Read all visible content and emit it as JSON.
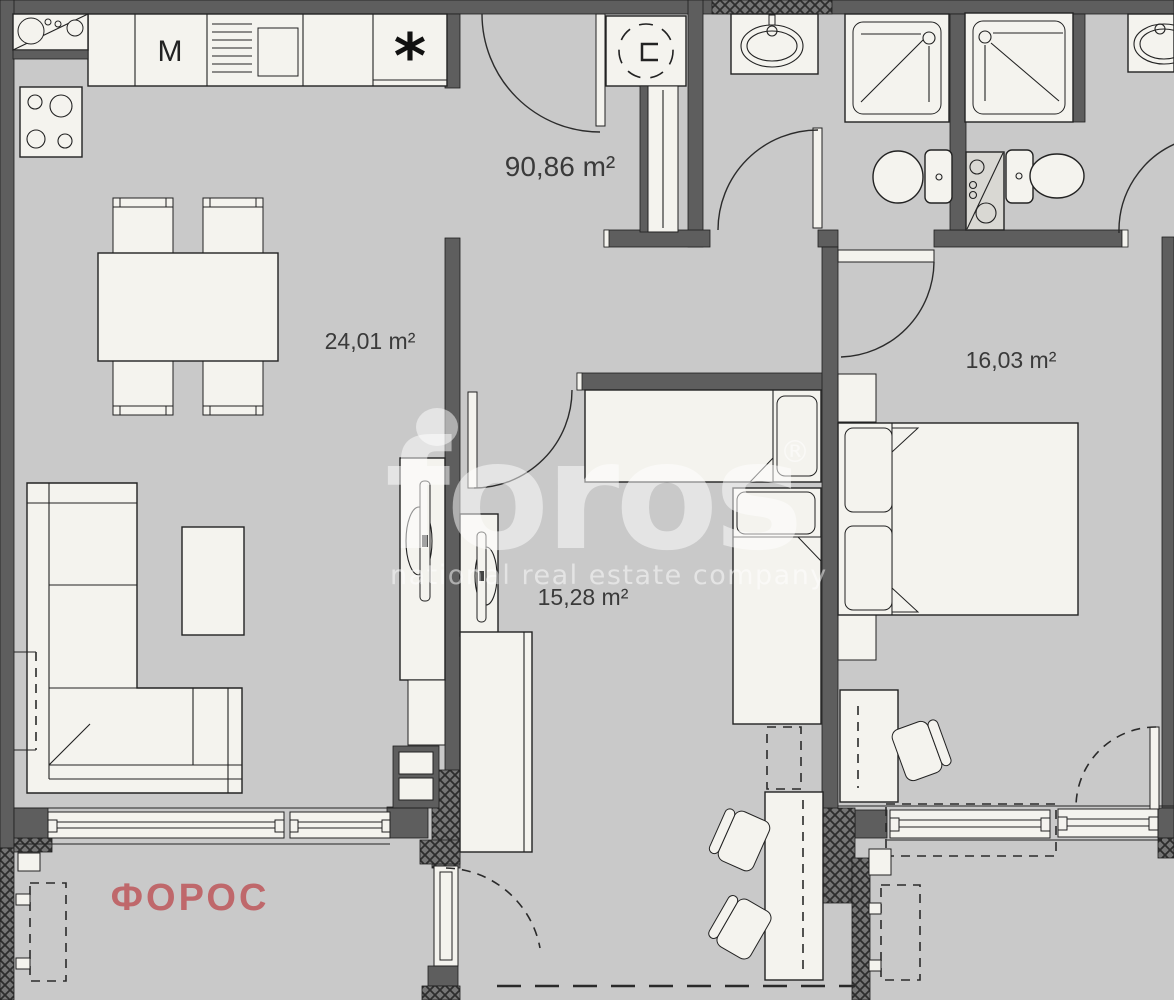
{
  "plan_labels": {
    "total_area": "90,86 m²",
    "living_room_area": "24,01 m²",
    "second_room_area": "15,28 m²",
    "bedroom_area": "16,03 m²"
  },
  "kitchen": {
    "washing_machine_label": "M",
    "fridge_symbol": "*"
  },
  "branding": {
    "watermark_logo": "foros",
    "watermark_registered": "®",
    "watermark_tagline": "national real estate company",
    "agency_name": "ФОРОС",
    "agency_color": "#bf686b"
  },
  "colors": {
    "wall": "#5e5e5e",
    "floor": "#c9c9c9",
    "furniture": "#f4f3ee",
    "outline": "#222222",
    "label_text": "#3a3a3a",
    "watermark": "#dddddd",
    "hatch_background": "#757575"
  },
  "icons": {
    "kitchen_sink": "sink-icon",
    "stove": "stove-icon",
    "washing_machine": "washing-machine-icon",
    "oven": "oven-icon",
    "fridge": "fridge-icon",
    "boiler": "boiler-icon",
    "shower": "shower-icon",
    "toilet": "toilet-icon",
    "wash_basin": "basin-icon",
    "bed": "bed-icon",
    "sofa": "sofa-icon",
    "desk_chair": "chair-icon"
  }
}
